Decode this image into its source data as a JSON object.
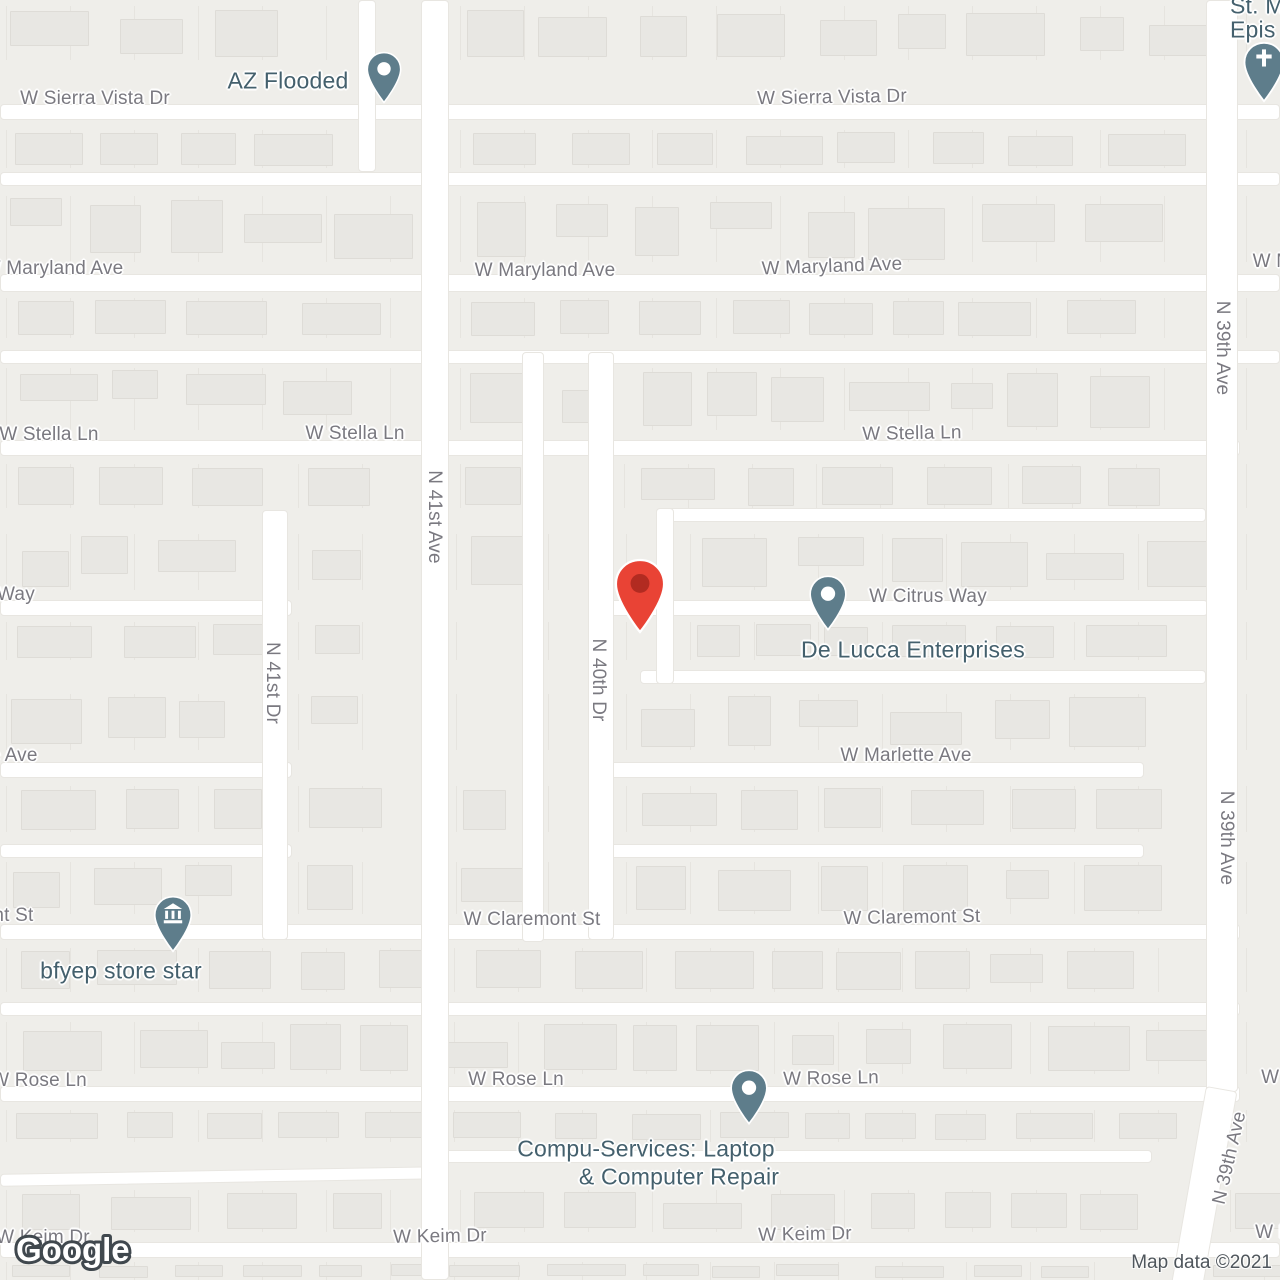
{
  "attribution": "Map data ©2021",
  "logo_text": "Google",
  "colors": {
    "land": "#efeeea",
    "road_fill": "#ffffff",
    "road_casing": "#e8e6e1",
    "building_fill": "#e8e7e3",
    "building_line": "#dedcd7",
    "lot_line": "#e6e4df",
    "street_label": "#7a7980",
    "poi_label": "#44606d",
    "poi_pin": "#5e7d8b",
    "destination_pin": "#e94335",
    "destination_pin_dot": "#b22b21",
    "attribution_color": "#4f565c"
  },
  "street_labels": [
    {
      "text": "W Sierra Vista Dr",
      "x": 95,
      "y": 99,
      "rot": 0
    },
    {
      "text": "W Sierra Vista Dr",
      "x": 832,
      "y": 98,
      "rot": -1
    },
    {
      "text": "W Maryland Ave",
      "x": 53,
      "y": 269,
      "rot": 0
    },
    {
      "text": "W Maryland Ave",
      "x": 545,
      "y": 271,
      "rot": 0
    },
    {
      "text": "W Maryland Ave",
      "x": 832,
      "y": 267,
      "rot": -2
    },
    {
      "text": "W Maryland Ave",
      "x": 1323,
      "y": 262,
      "rot": 0
    },
    {
      "text": "W Stella Ln",
      "x": 49,
      "y": 435,
      "rot": 0
    },
    {
      "text": "W Stella Ln",
      "x": 355,
      "y": 434,
      "rot": 0
    },
    {
      "text": "W Stella Ln",
      "x": 912,
      "y": 434,
      "rot": -1
    },
    {
      "text": "W Citrus Way",
      "x": -24,
      "y": 595,
      "rot": 0
    },
    {
      "text": "W Citrus Way",
      "x": 928,
      "y": 597,
      "rot": 0
    },
    {
      "text": "W Marlette Ave",
      "x": -28,
      "y": 756,
      "rot": 0
    },
    {
      "text": "W Marlette Ave",
      "x": 906,
      "y": 756,
      "rot": 0
    },
    {
      "text": "W Claremont St",
      "x": -35,
      "y": 916,
      "rot": 0
    },
    {
      "text": "W Claremont St",
      "x": 532,
      "y": 920,
      "rot": 0
    },
    {
      "text": "W Claremont St",
      "x": 912,
      "y": 918,
      "rot": -1
    },
    {
      "text": "W Rose Ln",
      "x": 39,
      "y": 1081,
      "rot": 0
    },
    {
      "text": "W Rose Ln",
      "x": 516,
      "y": 1080,
      "rot": 0
    },
    {
      "text": "W Rose Ln",
      "x": 831,
      "y": 1079,
      "rot": -1
    },
    {
      "text": "W Rose Ln",
      "x": 1309,
      "y": 1078,
      "rot": 0
    },
    {
      "text": "W Keim Dr",
      "x": 43,
      "y": 1238,
      "rot": 0
    },
    {
      "text": "W Keim Dr",
      "x": 440,
      "y": 1237,
      "rot": -1
    },
    {
      "text": "W Keim Dr",
      "x": 805,
      "y": 1235,
      "rot": -1
    },
    {
      "text": "W Keim Dr",
      "x": 1302,
      "y": 1233,
      "rot": 0
    },
    {
      "text": "N 41st Ave",
      "x": 434,
      "y": 517,
      "rot": 90
    },
    {
      "text": "N 41st Dr",
      "x": 272,
      "y": 683,
      "rot": 90
    },
    {
      "text": "N 40th Dr",
      "x": 598,
      "y": 680,
      "rot": 90
    },
    {
      "text": "N 39th Ave",
      "x": 1222,
      "y": 348,
      "rot": 90
    },
    {
      "text": "N 39th Ave",
      "x": 1226,
      "y": 838,
      "rot": 90
    },
    {
      "text": "N 39th Ave",
      "x": 1230,
      "y": 1158,
      "rot": -77
    }
  ],
  "poi_labels": [
    {
      "text": "AZ Flooded",
      "x": 288,
      "y": 81,
      "align": "center"
    },
    {
      "text": "St. M",
      "x": 1230,
      "y": 6,
      "align": "left"
    },
    {
      "text": "Epis",
      "x": 1230,
      "y": 30,
      "align": "left"
    },
    {
      "text": "De Lucca Enterprises",
      "x": 913,
      "y": 650,
      "align": "center"
    },
    {
      "text": "bfyep store star",
      "x": 121,
      "y": 971,
      "align": "center"
    },
    {
      "text": "Compu-Services: Laptop",
      "x": 646,
      "y": 1149,
      "align": "center"
    },
    {
      "text": "& Computer Repair",
      "x": 679,
      "y": 1177,
      "align": "center"
    }
  ],
  "pins": [
    {
      "name": "az-flooded-pin",
      "kind": "poi",
      "x": 384,
      "tip_y": 104,
      "w": 40,
      "h": 53
    },
    {
      "name": "church-pin",
      "kind": "church",
      "x": 1264,
      "tip_y": 103,
      "w": 46,
      "h": 62
    },
    {
      "name": "de-lucca-pin",
      "kind": "poi",
      "x": 828,
      "tip_y": 632,
      "w": 40,
      "h": 58
    },
    {
      "name": "bfyep-store-pin",
      "kind": "bank",
      "x": 173,
      "tip_y": 953,
      "w": 42,
      "h": 58
    },
    {
      "name": "compu-services-pin",
      "kind": "poi",
      "x": 749,
      "tip_y": 1126,
      "w": 40,
      "h": 58
    },
    {
      "name": "destination-pin",
      "kind": "destination",
      "x": 640,
      "tip_y": 638,
      "w": 54,
      "h": 84
    }
  ]
}
